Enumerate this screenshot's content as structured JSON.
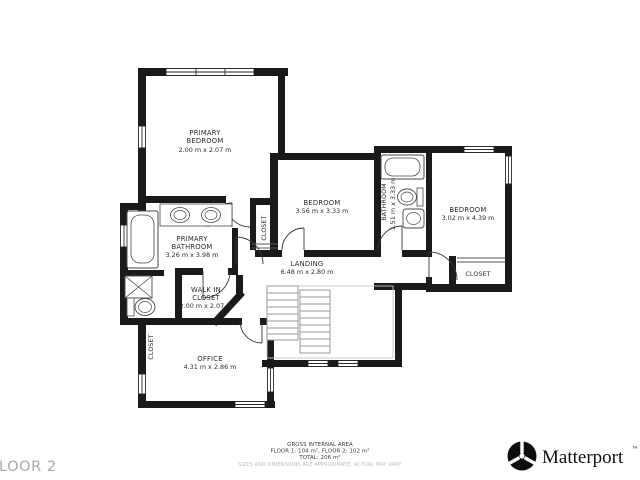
{
  "floor_label": "FLOOR 2",
  "footer": {
    "line1": "GROSS INTERNAL AREA",
    "line2": "FLOOR 1: 104 m², FLOOR 2: 102 m²",
    "line3": "TOTAL: 206 m²",
    "disclaimer": "SIZES AND DIMENSIONS ARE APPROXIMATE, ACTUAL MAY VARY."
  },
  "brand": {
    "name": "Matterport",
    "trademark": "™"
  },
  "rooms": {
    "primary_bedroom": {
      "name_line1": "PRIMARY",
      "name_line2": "BEDROOM",
      "dims": "2.00 m x 2.07 m"
    },
    "bedroom_middle": {
      "name": "BEDROOM",
      "dims": "3.56 m x 3.33 m"
    },
    "bathroom_middle": {
      "name": "BATHROOM",
      "dims": "1.51 m x 3.33 m"
    },
    "bedroom_right": {
      "name": "BEDROOM",
      "dims": "3.02 m x 4.39 m"
    },
    "closet_right": {
      "name": "CLOSET"
    },
    "closet_hall": {
      "name": "CLOSET"
    },
    "landing": {
      "name": "LANDING",
      "dims": "6.48 m x 2.80 m"
    },
    "primary_bathroom": {
      "name_line1": "PRIMARY",
      "name_line2": "BATHROOM",
      "dims": "3.26 m x 3.98 m"
    },
    "walk_in_closet": {
      "name_line1": "WALK IN",
      "name_line2": "CLOSET",
      "dims": "2.00 m x 2.07 m"
    },
    "closet_office": {
      "name": "CLOSET"
    },
    "office": {
      "name": "OFFICE",
      "dims": "4.31 m x 2.86 m"
    }
  },
  "colors": {
    "wall": "#1a1a1a",
    "fixture": "#4a4a4a",
    "stairs": "#999999",
    "muted": "#bdbdbd"
  }
}
